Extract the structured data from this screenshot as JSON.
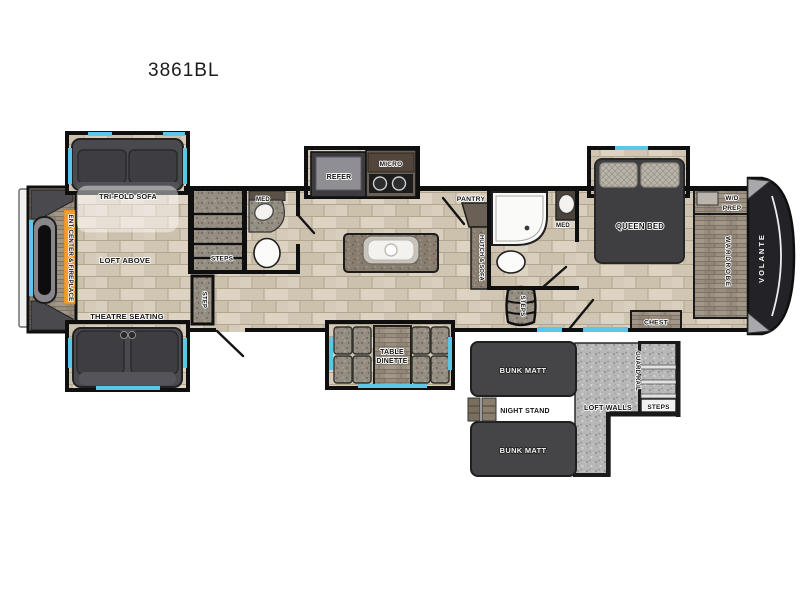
{
  "title": "3861BL",
  "brand": "VOLANTE",
  "colors": {
    "accent_orange": "#F49C2D",
    "window_cyan": "#5BC6E8",
    "front_cap_dark": "#232327",
    "wall_black": "#0F0F0F",
    "floor_tan": "#D6CCBC",
    "loft_gray": "#B7B7B7"
  },
  "main": {
    "living": {
      "tri_fold_sofa": "TRI-FOLD SOFA",
      "loft_above": "LOFT ABOVE",
      "theatre_seating": "THEATRE SEATING",
      "ent_center_fireplace": "ENT CENTER & FIREPLACE"
    },
    "entry": {
      "step": "STEP"
    },
    "mid_bath": {
      "steps": "STEPS",
      "med": "MED"
    },
    "kitchen": {
      "refer": "REFER",
      "micro": "MICRO",
      "pantry": "PANTRY",
      "hutch_sofa": "HUTCH & SOFA",
      "table": "TABLE",
      "dinette": "DINETTE"
    },
    "front_bath": {
      "med": "MED",
      "steps": "STEPS"
    },
    "bedroom": {
      "queen_bed": "QUEEN BED",
      "chest": "CHEST",
      "wd_prep_line1": "W/D",
      "wd_prep_line2": "PREP",
      "wardrobe": "WARDROBE"
    }
  },
  "loft": {
    "bunk_matt_top": "BUNK MATT",
    "night_stand": "NIGHT STAND",
    "bunk_matt_bottom": "BUNK MATT",
    "loft_walls": "LOFT WALLS",
    "guard_rail": "GUARD RAIL",
    "steps": "STEPS"
  }
}
